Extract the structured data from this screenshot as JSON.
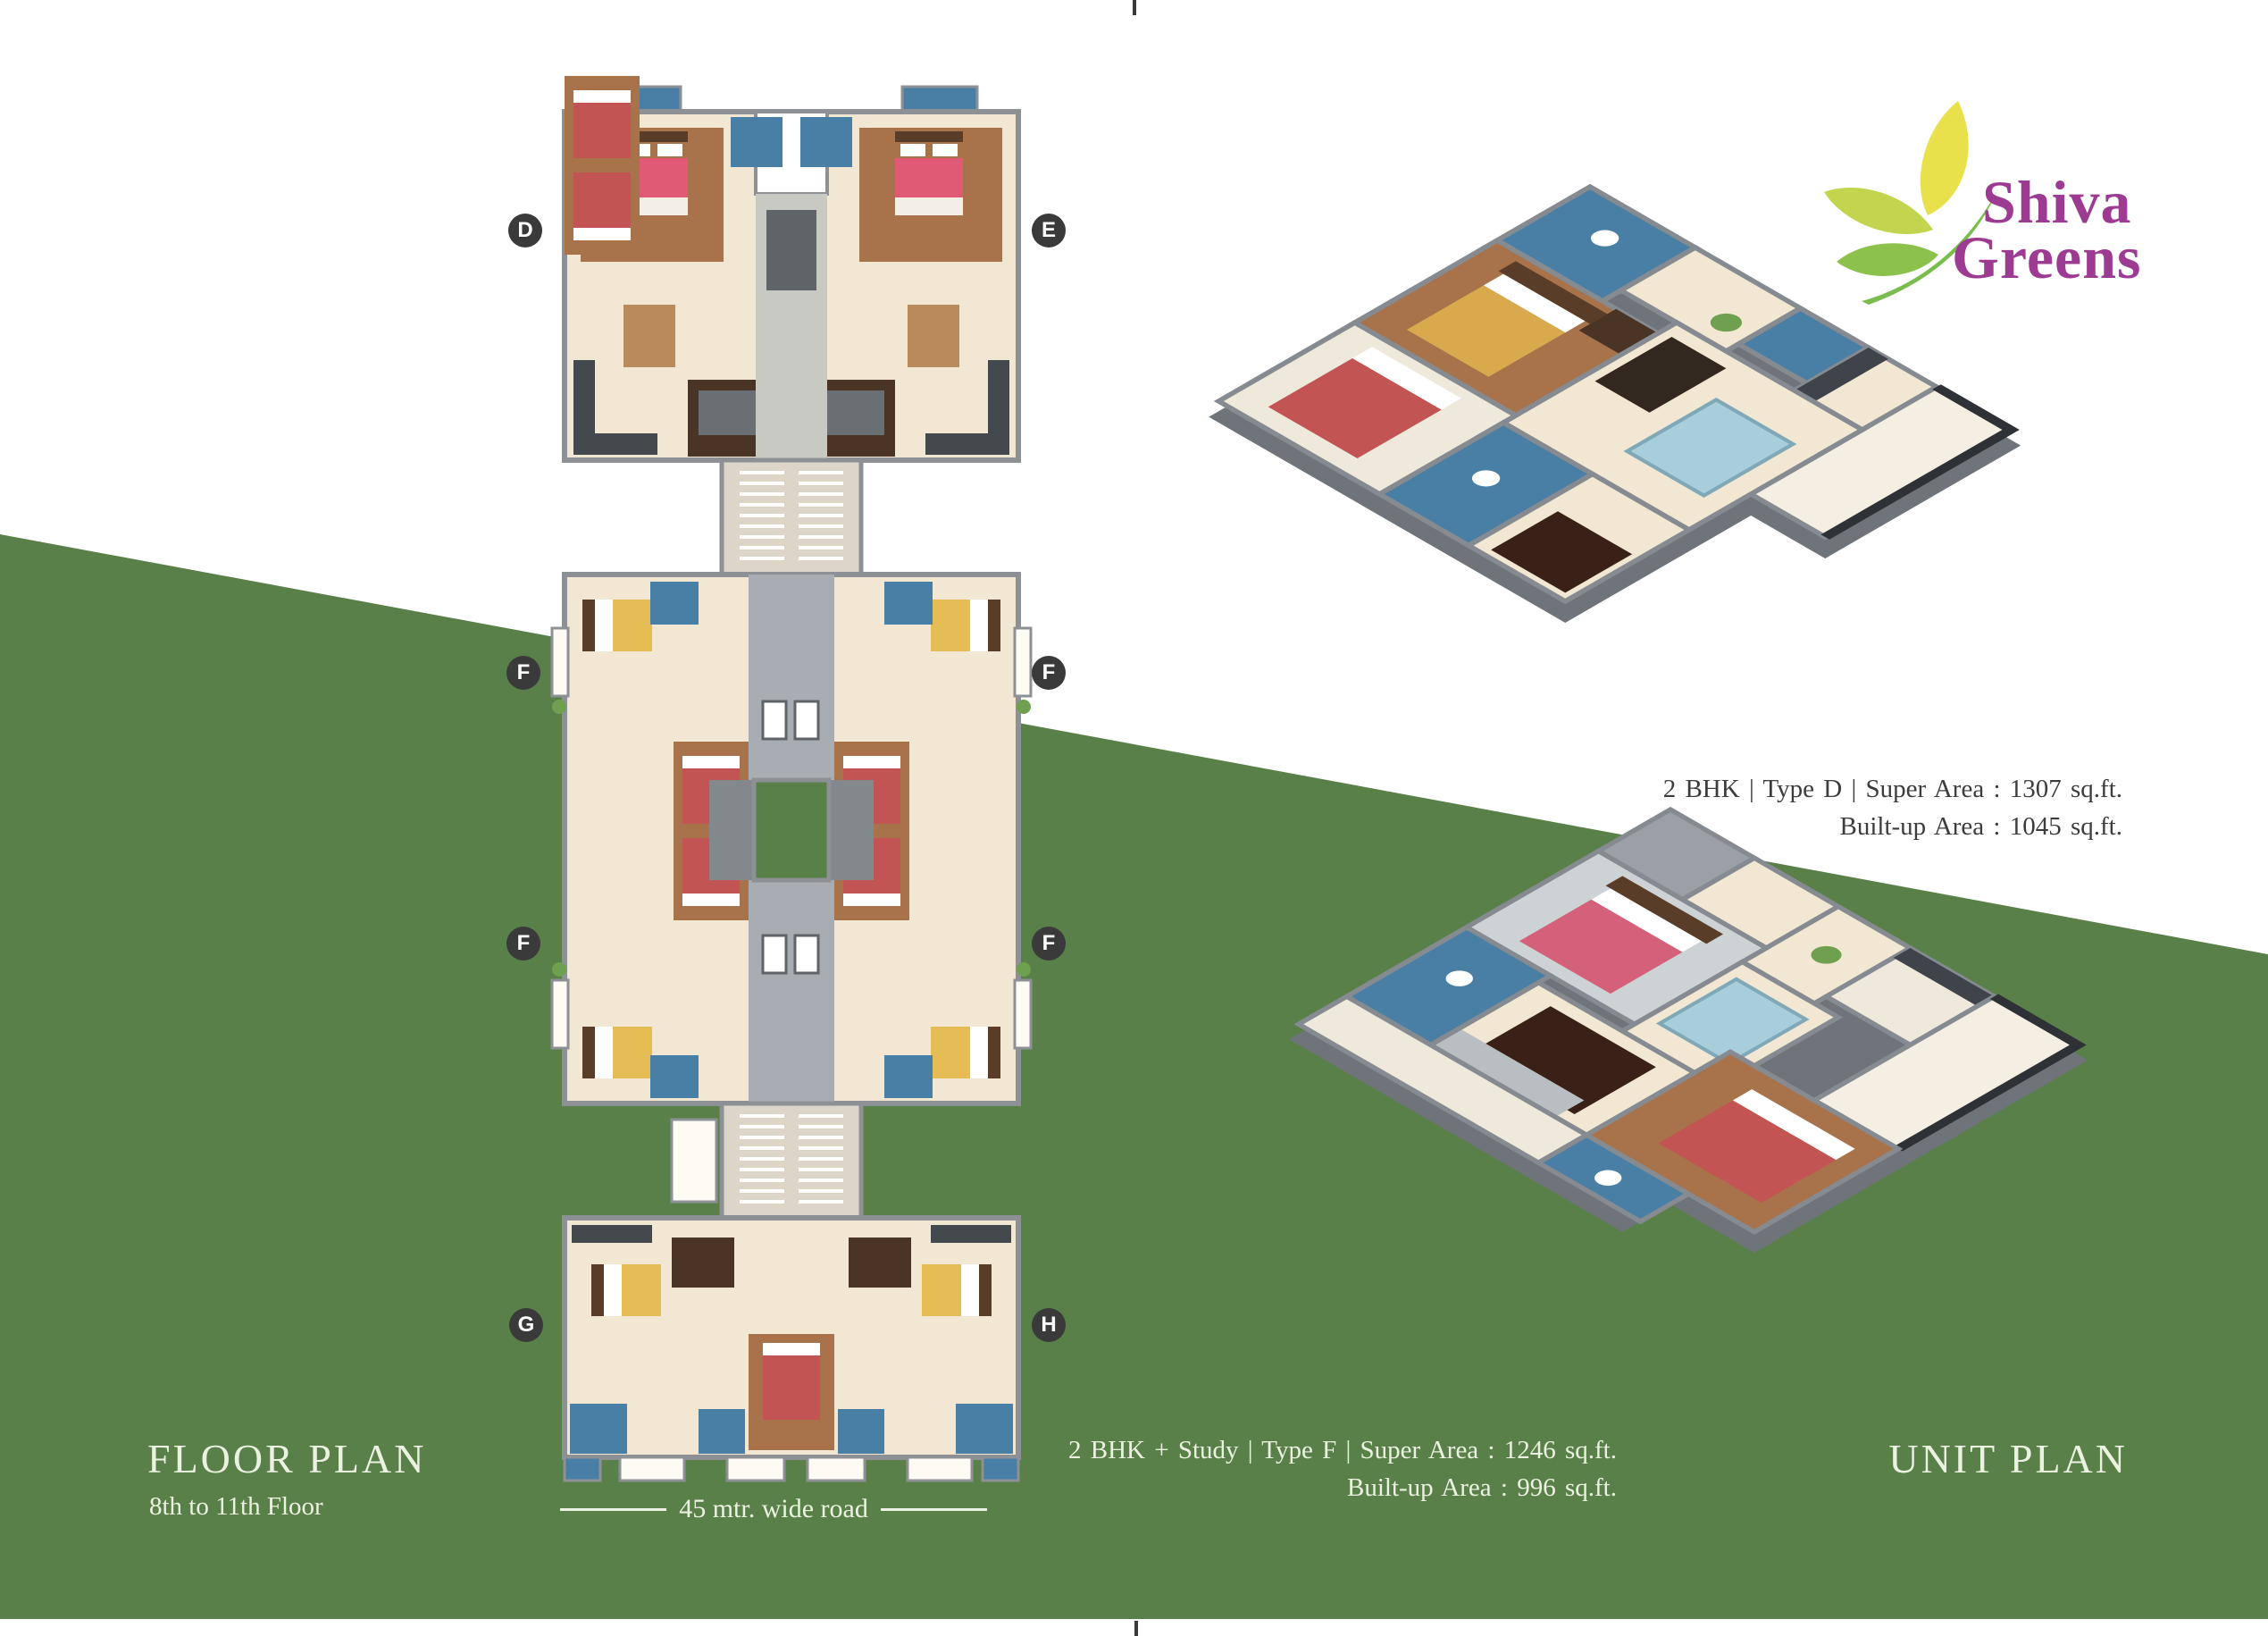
{
  "branding": {
    "name_line1": "Shiva",
    "name_line2": "Greens"
  },
  "floor_plan": {
    "title": "FLOOR PLAN",
    "subtitle": "8th to 11th Floor",
    "road_label": "45 mtr. wide road",
    "unit_labels": [
      "D",
      "E",
      "F",
      "F",
      "F",
      "F",
      "G",
      "H"
    ]
  },
  "unit_plan": {
    "title": "UNIT PLAN",
    "type_d": {
      "line1": "2 BHK  |  Type D  |  Super Area : 1307 sq.ft.",
      "line2": "Built-up Area : 1045 sq.ft."
    },
    "type_f": {
      "line1": "2 BHK + Study  |  Type F  |  Super Area : 1246 sq.ft.",
      "line2": "Built-up Area : 996 sq.ft."
    }
  },
  "colors": {
    "background_green": "#5a8049",
    "logo_magenta": "#9d3a92",
    "label_circle_bg": "#3a3a3a",
    "caption_text_dark": "#3c3c3c",
    "text_cream": "#ecf2e1"
  }
}
